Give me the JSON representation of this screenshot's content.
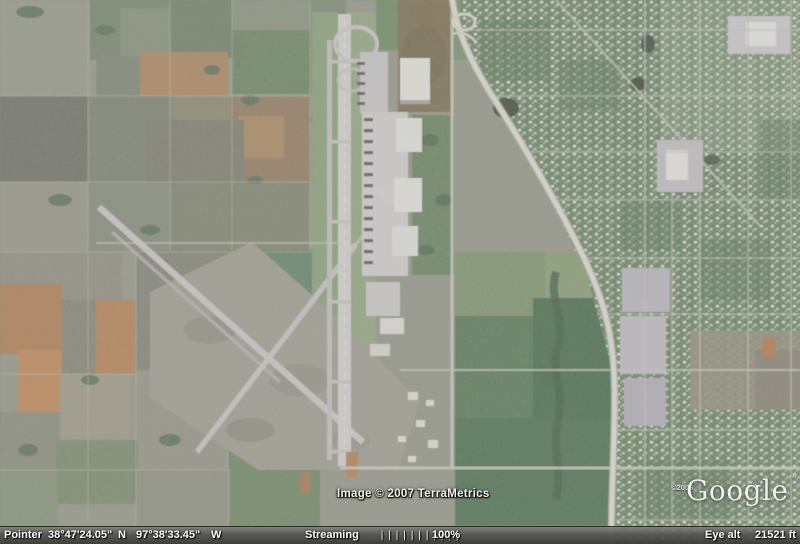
{
  "map_overlays": {
    "image_credit": "Image © 2007 TerraMetrics",
    "logo_copyright": "©2006",
    "logo_text": "Google",
    "logo_tm": "™"
  },
  "status_bar": {
    "pointer_label": "Pointer",
    "latitude": "38°47'24.05\"",
    "lat_dir": "N",
    "longitude": "97°38'33.45\"",
    "lon_dir": "W",
    "streaming_label": "Streaming",
    "streaming_bars": "|||||||||||",
    "streaming_percent": "100%",
    "eye_alt_label": "Eye alt",
    "eye_alt_value": "21521 ft"
  },
  "colors": {
    "status_bar_bg": "#55554f",
    "overlay_text": "#ffffff",
    "farmland_orange": "#b06f3e",
    "urban_green": "#5b7a55",
    "runway_gray": "#dad6d9"
  }
}
